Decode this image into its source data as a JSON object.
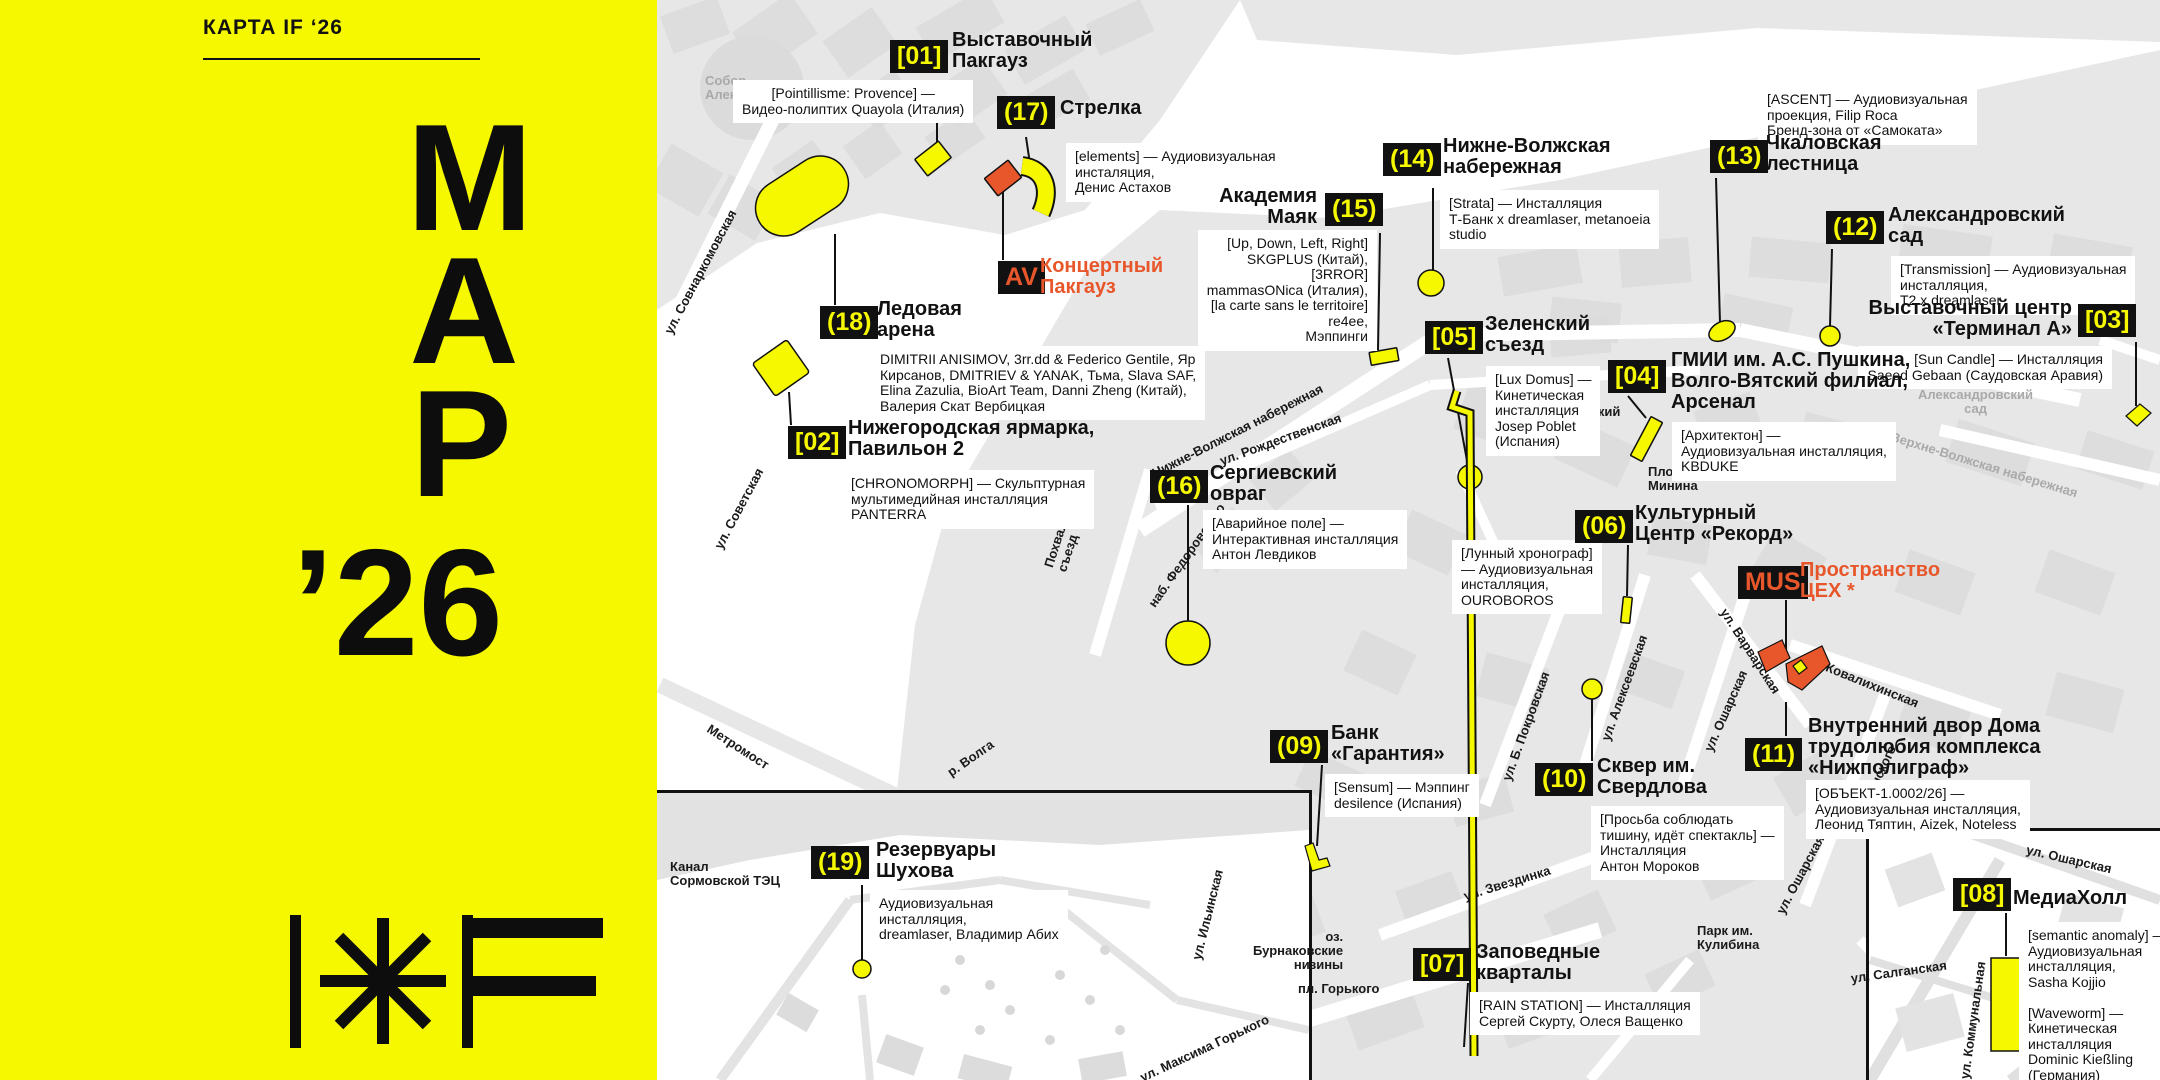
{
  "colors": {
    "yellow": "#F6F800",
    "orange": "#E8572B",
    "badge_bg": "#111111",
    "land_gray": "#E7E7E7",
    "block_gray": "#DBDBDB",
    "label_gray": "#A9A9A9"
  },
  "sidebar": {
    "kicker": "КАРТА IF ‘26",
    "title_lines": [
      "М",
      "А",
      "Р",
      "’26"
    ],
    "logo_name": "intervals-festival-logo"
  },
  "locations": [
    {
      "id": "01",
      "badge": "[01]",
      "bx": 890,
      "by": 40,
      "name": "Выставочный\nПакгауз",
      "nx": 952,
      "ny": 30,
      "desc": "[Pointillisme: Provence] —\nВидео-полиптих Quayola (Италия)",
      "dx": 733,
      "dy": 80,
      "dalign": "center"
    },
    {
      "id": "17",
      "badge": "(17)",
      "bx": 997,
      "by": 96,
      "name": "Стрелка",
      "nx": 1060,
      "ny": 98,
      "desc": "[elements] — Аудиовизуальная\nинсталяция,\nДенис Астахов",
      "dx": 1066,
      "dy": 143
    },
    {
      "id": "AV",
      "badge": "AV",
      "badge_color": "orange",
      "bx": 998,
      "by": 261,
      "name": "Концертный\nПакгауз",
      "name_color": "orange",
      "nx": 1040,
      "ny": 256
    },
    {
      "id": "18",
      "badge": "(18)",
      "bx": 820,
      "by": 306,
      "name": "Ледовая\nарена",
      "nx": 877,
      "ny": 299,
      "desc": "DIMITRII ANISIMOV, 3rr.dd & Federico Gentile, Яр\nКирсанов, DMITRIEV & YANAK, Тьма, Slava SAF,\nElina Zazulia, BioArt Team, Danni Zheng (Китай),\nВалерия Скат Вербицкая",
      "dx": 871,
      "dy": 346
    },
    {
      "id": "02",
      "badge": "[02]",
      "bx": 788,
      "by": 426,
      "name": "Нижегородская ярмарка,\nПавильон 2",
      "nx": 848,
      "ny": 418,
      "desc": "[CHRONOMORPH] — Скульптурная\nмультимедийная инсталляция\nPANTERRA",
      "dx": 842,
      "dy": 470
    },
    {
      "id": "15",
      "badge": "(15)",
      "bx": 1325,
      "by": 193,
      "name": "Академия\nМаяк",
      "nalign": "right",
      "nx": 1317,
      "ny": 186,
      "desc": "[Up, Down, Left, Right]\nSKGPLUS (Китай),\n[3RROR]\nmammasONica (Италия),\n[la carte sans le territoire]\nre4ee,\nМэппинги",
      "dalign": "right",
      "dx": 1377,
      "dy": 230
    },
    {
      "id": "14",
      "badge": "(14)",
      "bx": 1383,
      "by": 143,
      "name": "Нижне-Волжская\nнабережная",
      "nx": 1443,
      "ny": 136,
      "desc": "[Strata] — Инсталляция\nТ-Банк x dreamlaser, metanoeia\nstudio",
      "dx": 1440,
      "dy": 190
    },
    {
      "id": "13",
      "badge": "(13)",
      "bx": 1710,
      "by": 140,
      "name": "Чкаловская\nлестница",
      "nx": 1766,
      "ny": 133,
      "desc": "[ASCENT] — Аудиовизуальная\nпроекция, Filip Roca\nБренд-зона от «Самоката»",
      "dx": 1758,
      "dy": 86
    },
    {
      "id": "12",
      "badge": "(12)",
      "bx": 1826,
      "by": 211,
      "name": "Александровский\nсад",
      "nx": 1888,
      "ny": 205,
      "desc": "[Transmission] — Аудиовизуальная\nинсталляция,\nТ2 x dreamlaser",
      "dx": 1891,
      "dy": 256
    },
    {
      "id": "03",
      "badge": "[03]",
      "bx": 2078,
      "by": 304,
      "name": "Выставочный центр\n«Терминал А»",
      "nalign": "right",
      "nx": 2072,
      "ny": 298,
      "desc": "[Sun Candle] — Инсталляция\nSaeed Gebaan (Саудовская Аравия)",
      "dalign": "right",
      "dx": 2112,
      "dy": 346
    },
    {
      "id": "05",
      "badge": "[05]",
      "bx": 1425,
      "by": 321,
      "name": "Зеленский\nсъезд",
      "nx": 1485,
      "ny": 314,
      "desc": "[Lux Domus] —\nКинетическая\nинсталляция\nJosep Poblet\n(Испания)",
      "dx": 1486,
      "dy": 366
    },
    {
      "id": "04",
      "badge": "[04]",
      "bx": 1608,
      "by": 360,
      "name": "ГМИИ им. А.С. Пушкина,\nВолго-Вятский филиал,\nАрсенал",
      "nx": 1671,
      "ny": 350,
      "desc": "[Архитектон] —\nАудиовизуальная инсталляция,\nKBDUKE",
      "dx": 1672,
      "dy": 422
    },
    {
      "id": "16",
      "badge": "(16)",
      "bx": 1150,
      "by": 470,
      "name": "Сергиевский\nовраг",
      "nx": 1210,
      "ny": 463,
      "desc": "[Аварийное поле] —\nИнтерактивная инсталляция\nАнтон Левдиков",
      "dx": 1203,
      "dy": 510
    },
    {
      "id": "06",
      "badge": "(06)",
      "bx": 1575,
      "by": 510,
      "name": "Культурный\nЦентр «Рекорд»",
      "nx": 1635,
      "ny": 503,
      "desc": "[Лунный хронограф]\n— Аудиовизуальная\nинсталляция,\nOUROBOROS",
      "dx": 1452,
      "dy": 540
    },
    {
      "id": "MUS",
      "badge": "MUS",
      "badge_color": "orange",
      "bx": 1738,
      "by": 566,
      "name": "Пространство\nЦЕХ *",
      "name_color": "orange",
      "nx": 1800,
      "ny": 560
    },
    {
      "id": "09",
      "badge": "(09)",
      "bx": 1270,
      "by": 730,
      "name": "Банк\n«Гарантия»",
      "nx": 1331,
      "ny": 723,
      "desc": "[Sensum] — Мэппинг\ndesilence (Испания)",
      "dx": 1325,
      "dy": 774
    },
    {
      "id": "10",
      "badge": "(10)",
      "bx": 1535,
      "by": 763,
      "name": "Сквер им.\nСвердлова",
      "nx": 1597,
      "ny": 756,
      "desc": "[Просьба соблюдать\nтишину, идёт спектакль] —\nИнсталляция\nАнтон Мороков",
      "dx": 1591,
      "dy": 806
    },
    {
      "id": "11",
      "badge": "(11)",
      "bx": 1745,
      "by": 738,
      "name": "Внутренний двор Дома\nтрудолюбия комплекса\n«Нижполиграф»",
      "nx": 1808,
      "ny": 716,
      "desc": "[ОБЪЕКТ-1.0002/26] —\nАудиовизуальная инсталляция,\nЛеонид Тяптин, Aizek, Noteless",
      "dx": 1806,
      "dy": 780
    },
    {
      "id": "07",
      "badge": "[07]",
      "bx": 1413,
      "by": 948,
      "name": "Заповедные\nкварталы",
      "nx": 1476,
      "ny": 942,
      "desc": "[RAIN STATION] — Инсталляция\nСергей Скурту, Олеся Ващенко",
      "dx": 1470,
      "dy": 992
    },
    {
      "id": "08",
      "badge": "[08]",
      "bx": 1953,
      "by": 878,
      "name": "МедиаХолл",
      "nx": 2013,
      "ny": 888,
      "desc": "[semantic anomaly] —\nАудиовизуальная\nинсталляция,\nSasha Kojjio\n\n[Waveworm] —\nКинетическая\nинсталляция\nDominic Kießling\n(Германия)",
      "dx": 2019,
      "dy": 922
    },
    {
      "id": "19",
      "badge": "(19)",
      "bx": 811,
      "by": 846,
      "name": "Резервуары\nШухова",
      "nx": 876,
      "ny": 840,
      "desc": "Аудиовизуальная\nинсталляция,\ndreamlaser, Владимир Абих",
      "dx": 870,
      "dy": 890
    }
  ],
  "street_labels": [
    {
      "text": "ул. Совнаркомовская",
      "x": 662,
      "y": 330,
      "rot": -62
    },
    {
      "text": "ул. Советская",
      "x": 712,
      "y": 545,
      "rot": -62
    },
    {
      "text": "Нижне-Волжская набережная",
      "x": 1150,
      "y": 468,
      "rot": -27
    },
    {
      "text": "ул. Рождественская",
      "x": 1218,
      "y": 455,
      "rot": -20
    },
    {
      "text": "Похвалинский\nсъезд",
      "x": 1042,
      "y": 565,
      "rot": -72
    },
    {
      "text": "наб. Федоровского",
      "x": 1146,
      "y": 602,
      "rot": -55
    },
    {
      "text": "ул. Ильинская",
      "x": 1190,
      "y": 958,
      "rot": -76
    },
    {
      "text": "пл. Горького",
      "x": 1298,
      "y": 982,
      "rot": 0
    },
    {
      "text": "ул. Максима Горького",
      "x": 1138,
      "y": 1072,
      "rot": -25
    },
    {
      "text": "ул. Звездинка",
      "x": 1462,
      "y": 890,
      "rot": -17
    },
    {
      "text": "ул. Б. Покровская",
      "x": 1500,
      "y": 778,
      "rot": -70
    },
    {
      "text": "ул. Алексеевская",
      "x": 1599,
      "y": 738,
      "rot": -70
    },
    {
      "text": "ул. Ошарская",
      "x": 1702,
      "y": 748,
      "rot": -66
    },
    {
      "text": "ул. Ошарская",
      "x": 1774,
      "y": 910,
      "rot": -62
    },
    {
      "text": "ул. Белинского",
      "x": 1845,
      "y": 832,
      "rot": -65
    },
    {
      "text": "ул. Варварская",
      "x": 1729,
      "y": 606,
      "rot": 57
    },
    {
      "text": "ул. Ковалихинская",
      "x": 1808,
      "y": 652,
      "rot": 22
    },
    {
      "text": "Метромост",
      "x": 712,
      "y": 722,
      "rot": 33
    },
    {
      "text": "р. Волга",
      "x": 945,
      "y": 768,
      "rot": -35
    },
    {
      "text": "ул. Ошарская",
      "x": 2028,
      "y": 843,
      "rot": 13
    },
    {
      "text": "ул. Салганская",
      "x": 1850,
      "y": 972,
      "rot": -8
    },
    {
      "text": "ул. Коммунальная",
      "x": 1958,
      "y": 1078,
      "rot": -82
    }
  ],
  "area_labels": [
    {
      "text": "Речной вокзал",
      "x": 1237,
      "y": 338
    },
    {
      "text": "Площадь\nМинина",
      "x": 1648,
      "y": 465
    },
    {
      "text": "Нижегородский\nкремль",
      "x": 1520,
      "y": 405,
      "align": "center"
    },
    {
      "text": "Парк им.\nКулибина",
      "x": 1697,
      "y": 924
    },
    {
      "text": "Канал\nСормовской ТЭЦ",
      "x": 670,
      "y": 860
    },
    {
      "text": "оз.\nБурнаковские\nнизины",
      "x": 1253,
      "y": 930,
      "align": "right"
    },
    {
      "text": "Собор\nАлександра Невского",
      "x": 705,
      "y": 74,
      "color": "gray"
    },
    {
      "text": "Александровский\nсад",
      "x": 1918,
      "y": 388,
      "align": "center",
      "color": "gray"
    },
    {
      "text": "Верхне-Волжская набережная",
      "x": 1893,
      "y": 430,
      "rot": 17,
      "color": "gray"
    }
  ],
  "markers": [
    {
      "id": "m18-pill",
      "type": "rect",
      "x": 752,
      "y": 168,
      "w": 100,
      "h": 56,
      "rx": 28,
      "rot": -33
    },
    {
      "id": "m02-pavilion",
      "type": "rect",
      "x": 760,
      "y": 348,
      "w": 42,
      "h": 40,
      "rx": 3,
      "rot": -35
    },
    {
      "id": "m01-a",
      "type": "rect",
      "x": 918,
      "y": 148,
      "w": 30,
      "h": 21,
      "rx": 1,
      "rot": -38
    },
    {
      "id": "m01-b",
      "type": "rect",
      "x": 988,
      "y": 167,
      "w": 30,
      "h": 22,
      "rx": 1,
      "rot": -38,
      "fill": "orange"
    },
    {
      "id": "m17-arc",
      "type": "arc",
      "d": "M1022,166 C1046,169 1051,191 1041,213"
    },
    {
      "id": "m15-mayak",
      "type": "rect",
      "x": 1370,
      "y": 350,
      "w": 28,
      "h": 13,
      "rx": 1,
      "rot": -10
    },
    {
      "id": "m14-circle",
      "type": "circle",
      "x": 1431,
      "y": 283,
      "r": 13
    },
    {
      "id": "m05-circle",
      "type": "circle",
      "x": 1470,
      "y": 477,
      "r": 12
    },
    {
      "id": "m13-ellipse",
      "type": "ellipse",
      "x": 1722,
      "y": 331,
      "rx": 14,
      "ry": 9,
      "rot": -28
    },
    {
      "id": "m12-circle",
      "type": "circle",
      "x": 1830,
      "y": 336,
      "r": 10
    },
    {
      "id": "m03-diamond",
      "type": "poly",
      "points": "2126,416 2140,404 2151,413 2137,426"
    },
    {
      "id": "m04-bar",
      "type": "rect",
      "x": 1640,
      "y": 417,
      "w": 13,
      "h": 44,
      "rx": 1,
      "rot": 28
    },
    {
      "id": "m16-circle",
      "type": "circle",
      "x": 1188,
      "y": 643,
      "r": 22
    },
    {
      "id": "m06-bar",
      "type": "rect",
      "x": 1622,
      "y": 597,
      "w": 9,
      "h": 26,
      "rx": 1,
      "rot": 6
    },
    {
      "id": "m10-circle",
      "type": "circle",
      "x": 1592,
      "y": 689,
      "r": 10
    },
    {
      "id": "m09-flag",
      "type": "poly",
      "points": "1305,846 1313,843 1319,860 1327,858 1330,866 1312,871"
    },
    {
      "id": "mMUS-a",
      "type": "poly",
      "points": "1758,652 1782,640 1790,658 1766,672",
      "fill": "orange"
    },
    {
      "id": "mMUS-b",
      "type": "poly",
      "points": "1786,664 1822,646 1830,664 1802,690 1788,682",
      "fill": "orange"
    },
    {
      "id": "mMUS-dot",
      "type": "poly",
      "points": "1793,666 1801,660 1807,668 1799,674"
    },
    {
      "id": "m07-staple",
      "type": "arc",
      "d": "M1457,1048 L1452,1064 L1470,1070 L1474,1056",
      "w": 5
    },
    {
      "id": "m08-rect",
      "type": "rect",
      "x": 1991,
      "y": 958,
      "w": 29,
      "h": 93,
      "rx": 0,
      "rot": 0
    },
    {
      "id": "m19-circle",
      "type": "circle",
      "x": 862,
      "y": 969,
      "r": 9
    }
  ],
  "leaders": [
    [
      937,
      80,
      937,
      152
    ],
    [
      1026,
      137,
      1030,
      164
    ],
    [
      1003,
      190,
      1003,
      260
    ],
    [
      835,
      234,
      835,
      305
    ],
    [
      789,
      392,
      791,
      425
    ],
    [
      1380,
      233,
      1378,
      350
    ],
    [
      1433,
      188,
      1433,
      270
    ],
    [
      1716,
      178,
      1720,
      323
    ],
    [
      1832,
      249,
      1830,
      326
    ],
    [
      2136,
      342,
      2136,
      406
    ],
    [
      1448,
      358,
      1468,
      466
    ],
    [
      1628,
      396,
      1646,
      418
    ],
    [
      1188,
      505,
      1188,
      621
    ],
    [
      1628,
      545,
      1627,
      596
    ],
    [
      1322,
      765,
      1317,
      846
    ],
    [
      1592,
      699,
      1592,
      761
    ],
    [
      1786,
      600,
      1786,
      650
    ],
    [
      1786,
      702,
      1786,
      736
    ],
    [
      1468,
      983,
      1464,
      1047
    ],
    [
      2006,
      913,
      2006,
      956
    ],
    [
      862,
      885,
      862,
      960
    ]
  ]
}
